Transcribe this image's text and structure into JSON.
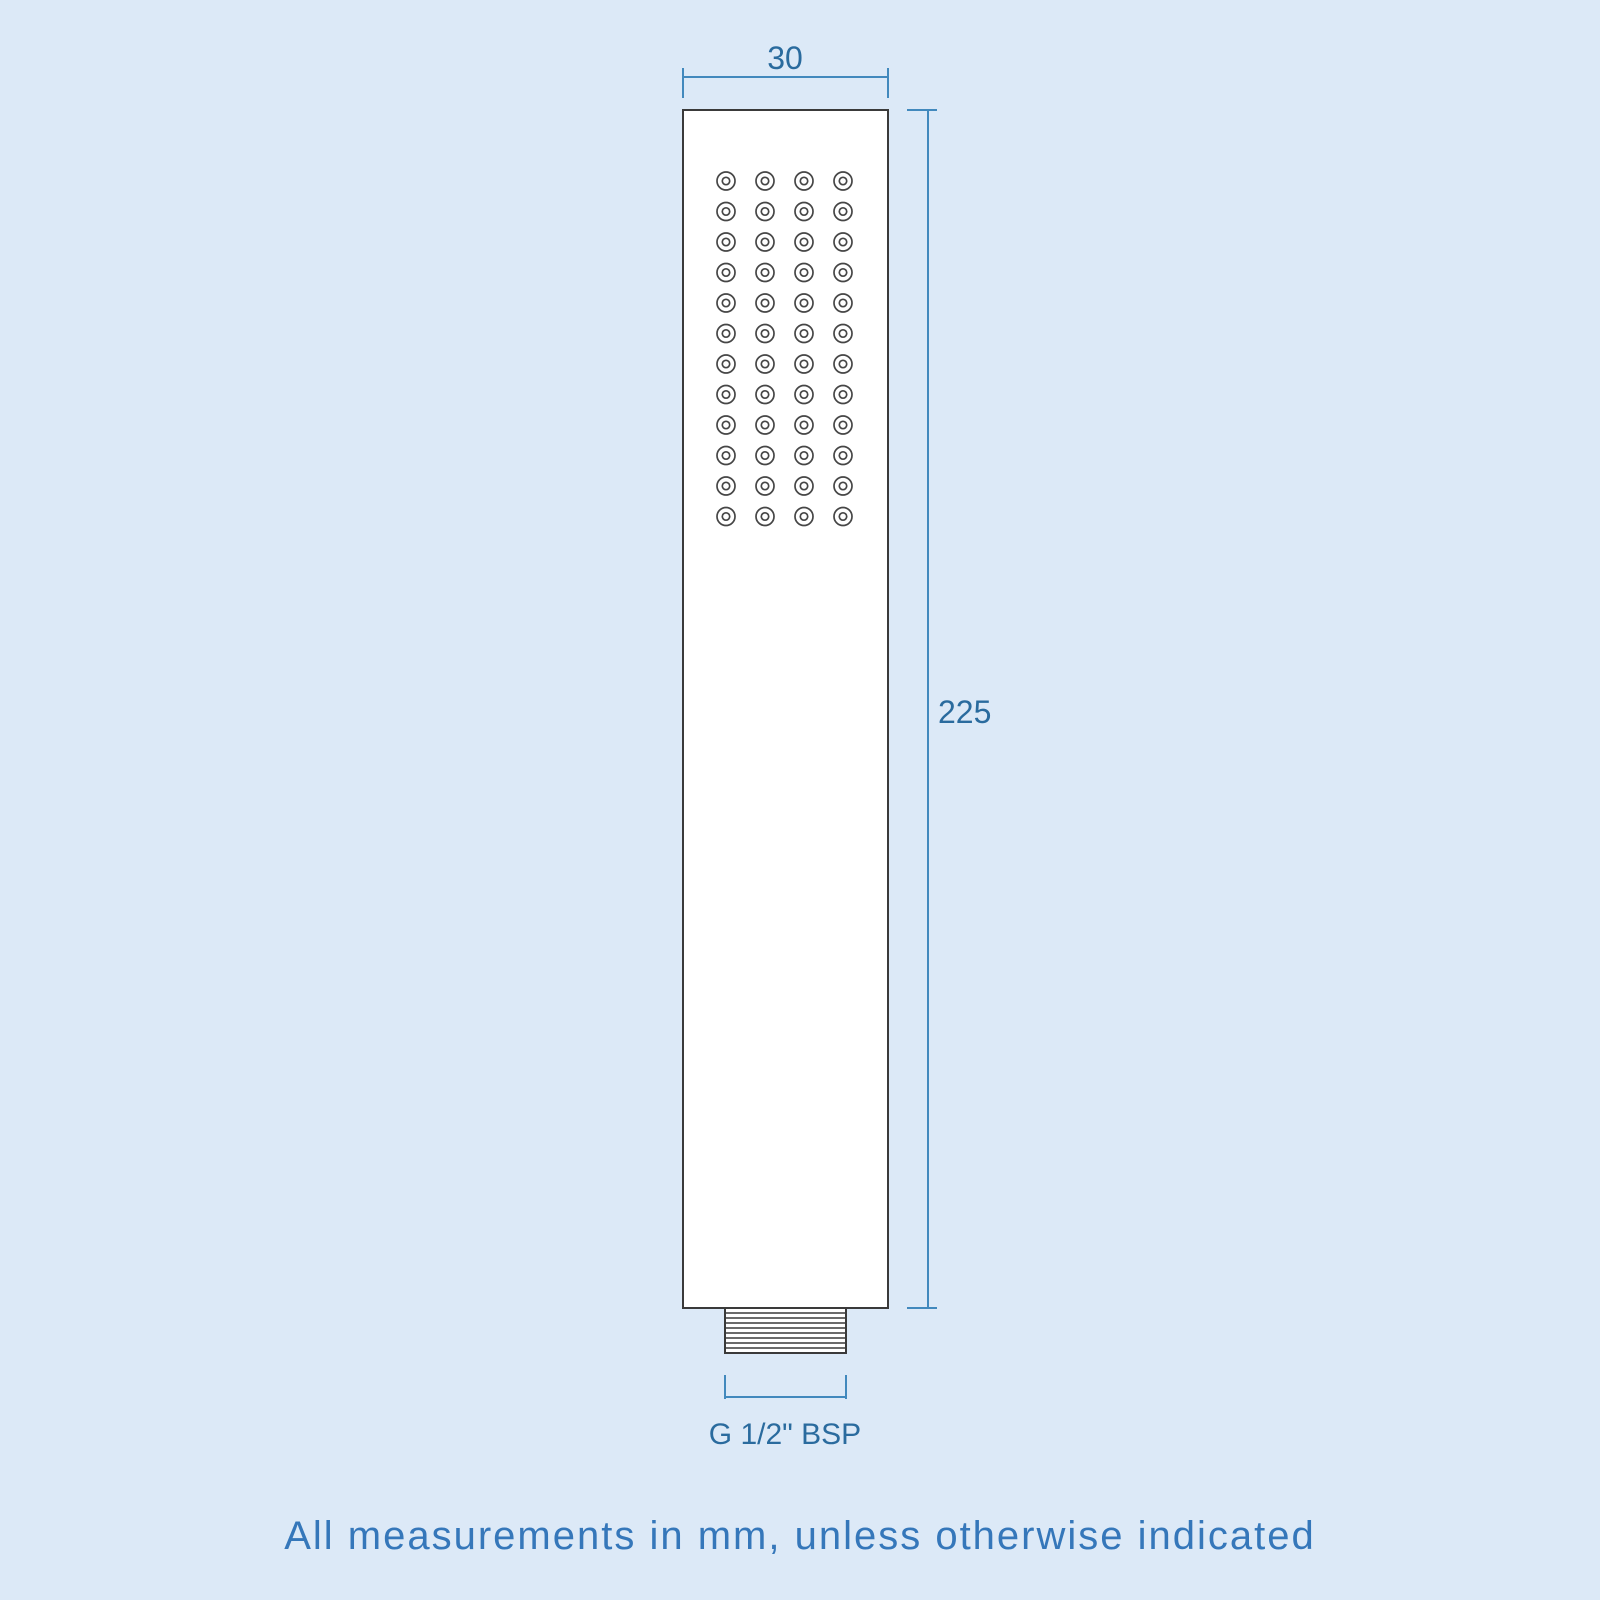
{
  "diagram": {
    "width_label": "30",
    "height_label": "225",
    "thread_label": "G 1/2\" BSP",
    "note": "All measurements in mm, unless otherwise indicated"
  },
  "colors": {
    "background": "#dce9f7",
    "drawing_outline": "#3a3a3a",
    "drawing_fill": "#ffffff",
    "dimension_line": "#4289bd",
    "dimension_text": "#2a6b9e",
    "note_text": "#3577ba"
  },
  "nozzle_grid": {
    "rows": 12,
    "cols": 4,
    "start_x": 726,
    "start_y": 181,
    "col_spacing": 39,
    "row_spacing": 30.5,
    "outer_radius": 9,
    "inner_radius": 3.7
  },
  "thread_connector": {
    "x": 725,
    "y": 1308,
    "width": 121,
    "height": 45,
    "line_count": 8
  }
}
